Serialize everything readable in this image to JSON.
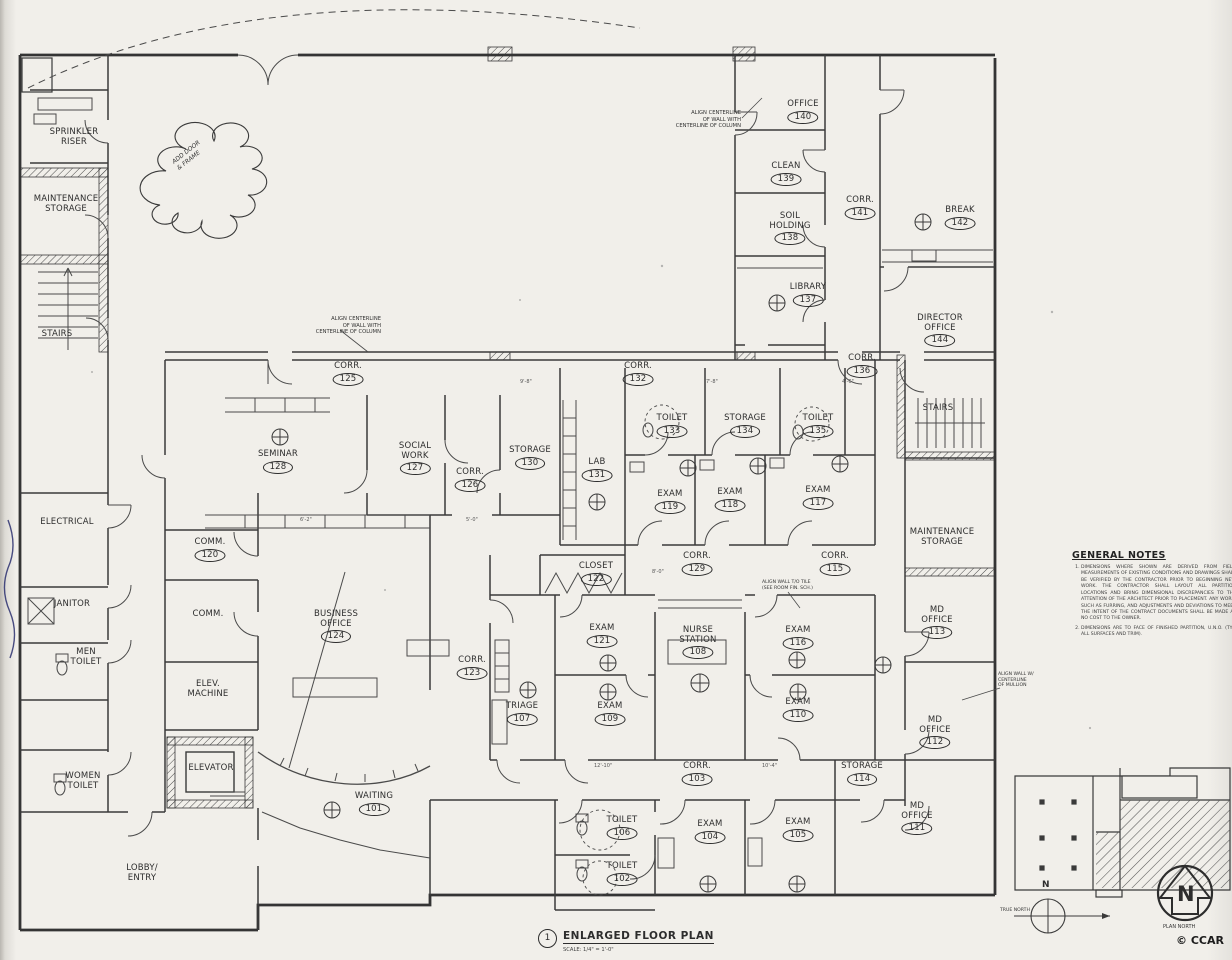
{
  "title_block": {
    "number": "1",
    "title": "ENLARGED FLOOR PLAN",
    "scale": "SCALE: 1/4\" = 1'-0\""
  },
  "copyright": {
    "text": "© CCAR"
  },
  "compass": {
    "true_north_letter": "N",
    "true_north_label": "TRUE NORTH",
    "plan_north_letter": "N",
    "plan_north_label": "PLAN NORTH"
  },
  "notes": {
    "heading": "GENERAL NOTES",
    "items": [
      "DIMENSIONS WHERE SHOWN ARE DERIVED FROM FIELD MEASUREMENTS OF EXISTING CONDITIONS AND DRAWINGS SHALL BE VERIFIED BY THE CONTRACTOR PRIOR TO BEGINNING NEW WORK. THE CONTRACTOR SHALL LAYOUT ALL PARTITION LOCATIONS AND BRING DIMENSIONAL DISCREPANCIES TO THE ATTENTION OF THE ARCHITECT PRIOR TO PLACEMENT. ANY WORK, SUCH AS FURRING, AND ADJUSTMENTS AND DEVIATIONS TO MEET THE INTENT OF THE CONTRACT DOCUMENTS SHALL BE MADE AT NO COST TO THE OWNER.",
      "DIMENSIONS ARE TO FACE OF FINISHED PARTITION, U.N.O. (TYP. ALL SURFACES AND TRIM)."
    ]
  },
  "annotations": {
    "align_column": "ALIGN CENTERLINE\nOF WALL WITH\nCENTERLINE OF COLUMN",
    "add_door": "ADD DOOR\n& FRAME",
    "align_mullion": "ALIGN WALL W/\nCENTERLINE\nOF MULLION",
    "align_tile": "ALIGN WALL T/O TILE\n(SEE ROOM FIN. SCH.)"
  },
  "dims": [
    "9'-8\"",
    "7'-8\"",
    "5'-0\"",
    "8'-0\"",
    "12'-10\"",
    "10'-4\"",
    "6'-2\"",
    "4'-6\""
  ],
  "rooms": [
    {
      "name": "SPRINKLER\nRISER"
    },
    {
      "name": "MAINTENANCE\nSTORAGE"
    },
    {
      "name": "STAIRS"
    },
    {
      "name": "OFFICE",
      "number": "140"
    },
    {
      "name": "CLEAN",
      "number": "139"
    },
    {
      "name": "SOIL\nHOLDING",
      "number": "138"
    },
    {
      "name": "CORR.",
      "number": "141"
    },
    {
      "name": "BREAK",
      "number": "142"
    },
    {
      "name": "LIBRARY",
      "number": "137"
    },
    {
      "name": "DIRECTOR\nOFFICE",
      "number": "144"
    },
    {
      "name": "CORR.",
      "number": "125"
    },
    {
      "name": "CORR.",
      "number": "132"
    },
    {
      "name": "CORR.",
      "number": "136"
    },
    {
      "name": "STAIRS"
    },
    {
      "name": "SEMINAR",
      "number": "128"
    },
    {
      "name": "SOCIAL\nWORK",
      "number": "127"
    },
    {
      "name": "CORR.",
      "number": "126"
    },
    {
      "name": "STORAGE",
      "number": "130"
    },
    {
      "name": "LAB",
      "number": "131"
    },
    {
      "name": "TOILET",
      "number": "133"
    },
    {
      "name": "STORAGE",
      "number": "134"
    },
    {
      "name": "TOILET",
      "number": "135"
    },
    {
      "name": "EXAM",
      "number": "119"
    },
    {
      "name": "EXAM",
      "number": "118"
    },
    {
      "name": "EXAM",
      "number": "117"
    },
    {
      "name": "MAINTENANCE\nSTORAGE"
    },
    {
      "name": "ELECTRICAL"
    },
    {
      "name": "COMM.",
      "number": "120"
    },
    {
      "name": "CLOSET",
      "number": "122"
    },
    {
      "name": "CORR.",
      "number": "129"
    },
    {
      "name": "CORR.",
      "number": "115"
    },
    {
      "name": "JANITOR"
    },
    {
      "name": "COMM."
    },
    {
      "name": "BUSINESS\nOFFICE",
      "number": "124"
    },
    {
      "name": "MEN\nTOILET"
    },
    {
      "name": "EXAM",
      "number": "121"
    },
    {
      "name": "NURSE\nSTATION",
      "number": "108"
    },
    {
      "name": "EXAM",
      "number": "116"
    },
    {
      "name": "MD\nOFFICE",
      "number": "113"
    },
    {
      "name": "CORR.",
      "number": "123"
    },
    {
      "name": "ELEV.\nMACHINE"
    },
    {
      "name": "TRIAGE",
      "number": "107"
    },
    {
      "name": "EXAM",
      "number": "109"
    },
    {
      "name": "EXAM",
      "number": "110"
    },
    {
      "name": "MD\nOFFICE",
      "number": "112"
    },
    {
      "name": "ELEVATOR"
    },
    {
      "name": "WOMEN\nTOILET"
    },
    {
      "name": "CORR.",
      "number": "103"
    },
    {
      "name": "STORAGE",
      "number": "114"
    },
    {
      "name": "WAITING",
      "number": "101"
    },
    {
      "name": "MD\nOFFICE",
      "number": "111"
    },
    {
      "name": "TOILET",
      "number": "106"
    },
    {
      "name": "EXAM",
      "number": "104"
    },
    {
      "name": "EXAM",
      "number": "105"
    },
    {
      "name": "TOILET",
      "number": "102"
    },
    {
      "name": "LOBBY/\nENTRY"
    }
  ]
}
